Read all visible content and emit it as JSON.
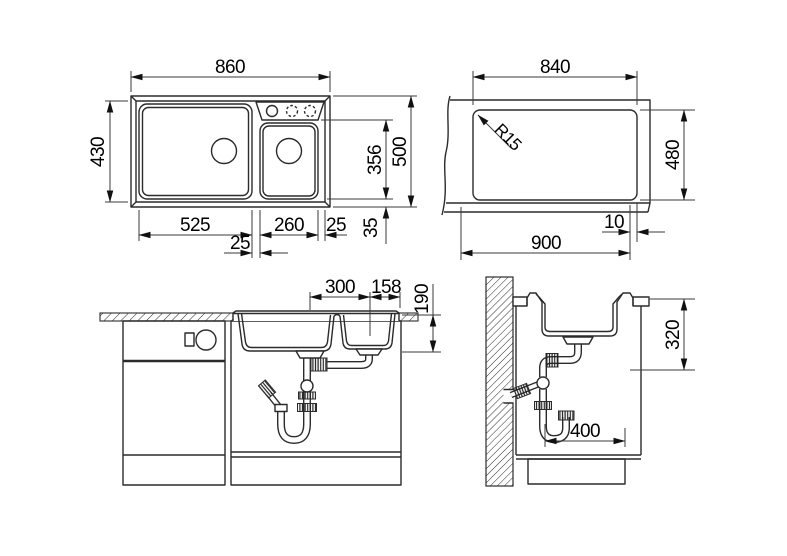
{
  "page": {
    "background": "#ffffff",
    "line_color": "#2b2b2b",
    "text_color": "#000000",
    "description": "sink installation technical drawing with four orthographic views"
  },
  "views": {
    "plan": {
      "name": "sink plan view",
      "width": "860",
      "inner_depth": "430",
      "bowl_depth": "356",
      "total_depth": "500",
      "rim_offset": "35",
      "left_bowl_width": "525",
      "divider_width": "25",
      "right_bowl_width": "260",
      "right_rim_offset": "25"
    },
    "cutout": {
      "name": "worktop cutout view",
      "width": "840",
      "height": "480",
      "corner_radius": "R15",
      "edge_offset": "10",
      "min_cabinet_width": "900"
    },
    "front": {
      "name": "front section view",
      "drain_spacing": "300",
      "drain_to_edge": "158",
      "right_bowl_depth": "190"
    },
    "side": {
      "name": "side section view",
      "install_depth": "320",
      "wall_clearance": "400"
    }
  }
}
